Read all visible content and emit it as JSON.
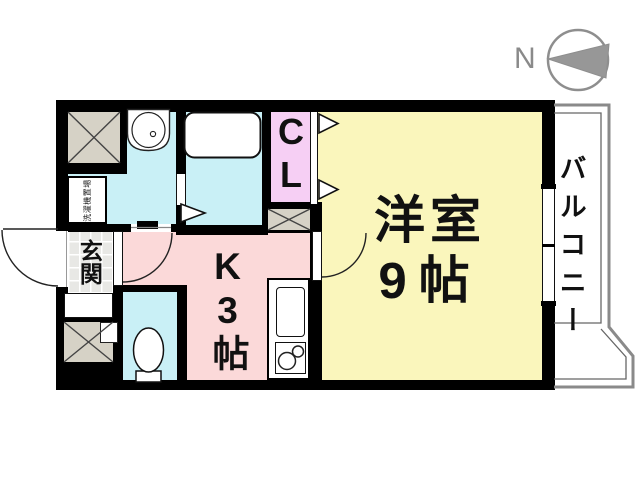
{
  "compass": {
    "north_label": "N"
  },
  "labels": {
    "living_line1": "洋室",
    "living_line2": "9帖",
    "kitchen_vertical": "K3帖",
    "closet_vertical": "CL",
    "entrance_vertical": "玄関",
    "balcony_vertical": "バルコニー",
    "washer_area": "洗濯機置場"
  },
  "colors": {
    "living_room": "#FAF6BC",
    "kitchen": "#FBD9D9",
    "closet": "#F6CFF4",
    "wet_rooms": "#C9F0F6",
    "storage_hatch": "#D6D2C6",
    "entrance_tile": "#E8E8E5",
    "wall": "#000000",
    "balcony_outline": "#8A8A8A",
    "compass_gray": "#8E8E8E"
  }
}
